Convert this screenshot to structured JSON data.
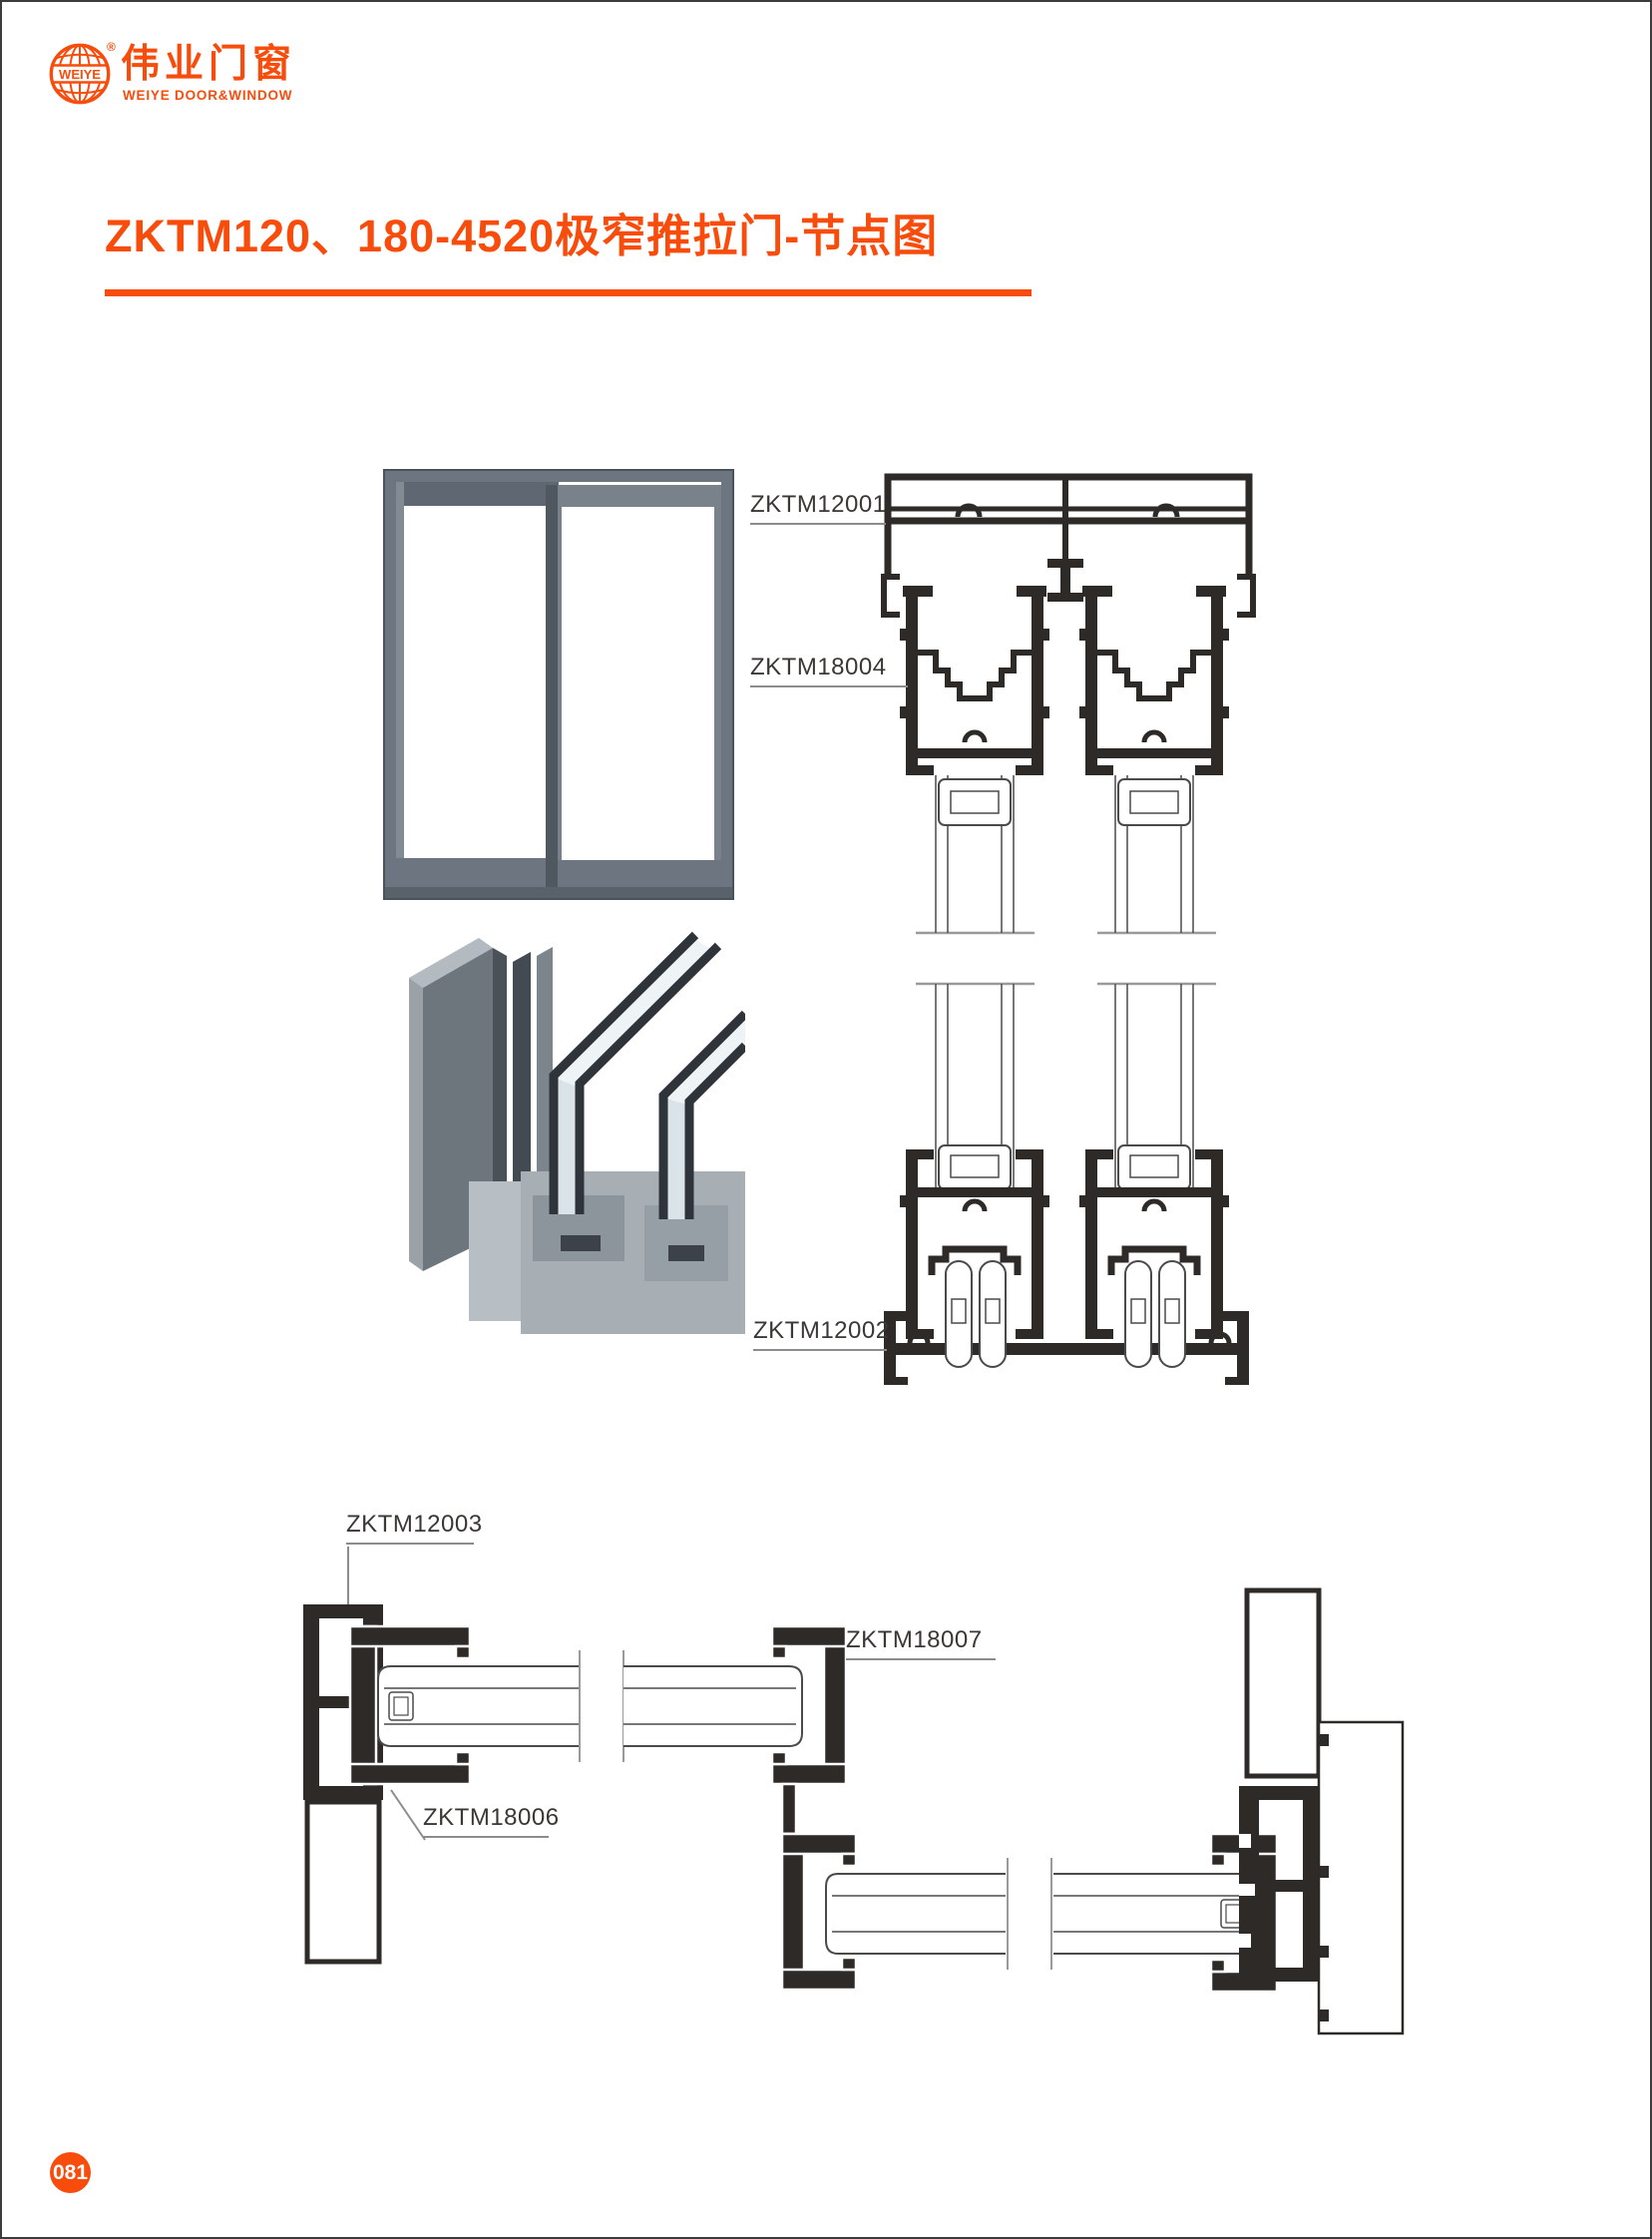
{
  "page": {
    "number": "081",
    "background": "#ffffff",
    "border_color": "#3c3c3c",
    "badge_color": "#f84c0c"
  },
  "brand": {
    "logo_icon": "globe-icon",
    "globe_text": "WEIYE",
    "registered": "®",
    "name_cn": "伟业门窗",
    "name_en": "WEIYE DOOR&WINDOW",
    "color": "#f84c0c"
  },
  "header": {
    "title": "ZKTM120、180-4520极窄推拉门-节点图",
    "underline_color": "#f84c0c"
  },
  "drawings": {
    "vertical_section": {
      "labels": {
        "top_frame": "ZKTM12001",
        "sash_profile": "ZKTM18004",
        "bottom_track": "ZKTM12002"
      }
    },
    "horizontal_section": {
      "labels": {
        "side_frame": "ZKTM12003",
        "interlock": "ZKTM18007",
        "side_sash": "ZKTM18006"
      }
    }
  },
  "colors": {
    "accent": "#f84c0c",
    "profile_line": "#2e2a28",
    "thin_line": "#4a4a4a",
    "leader_line": "#8c8c8c",
    "label_text": "#3b3734",
    "door_gray": "#6d7680"
  }
}
